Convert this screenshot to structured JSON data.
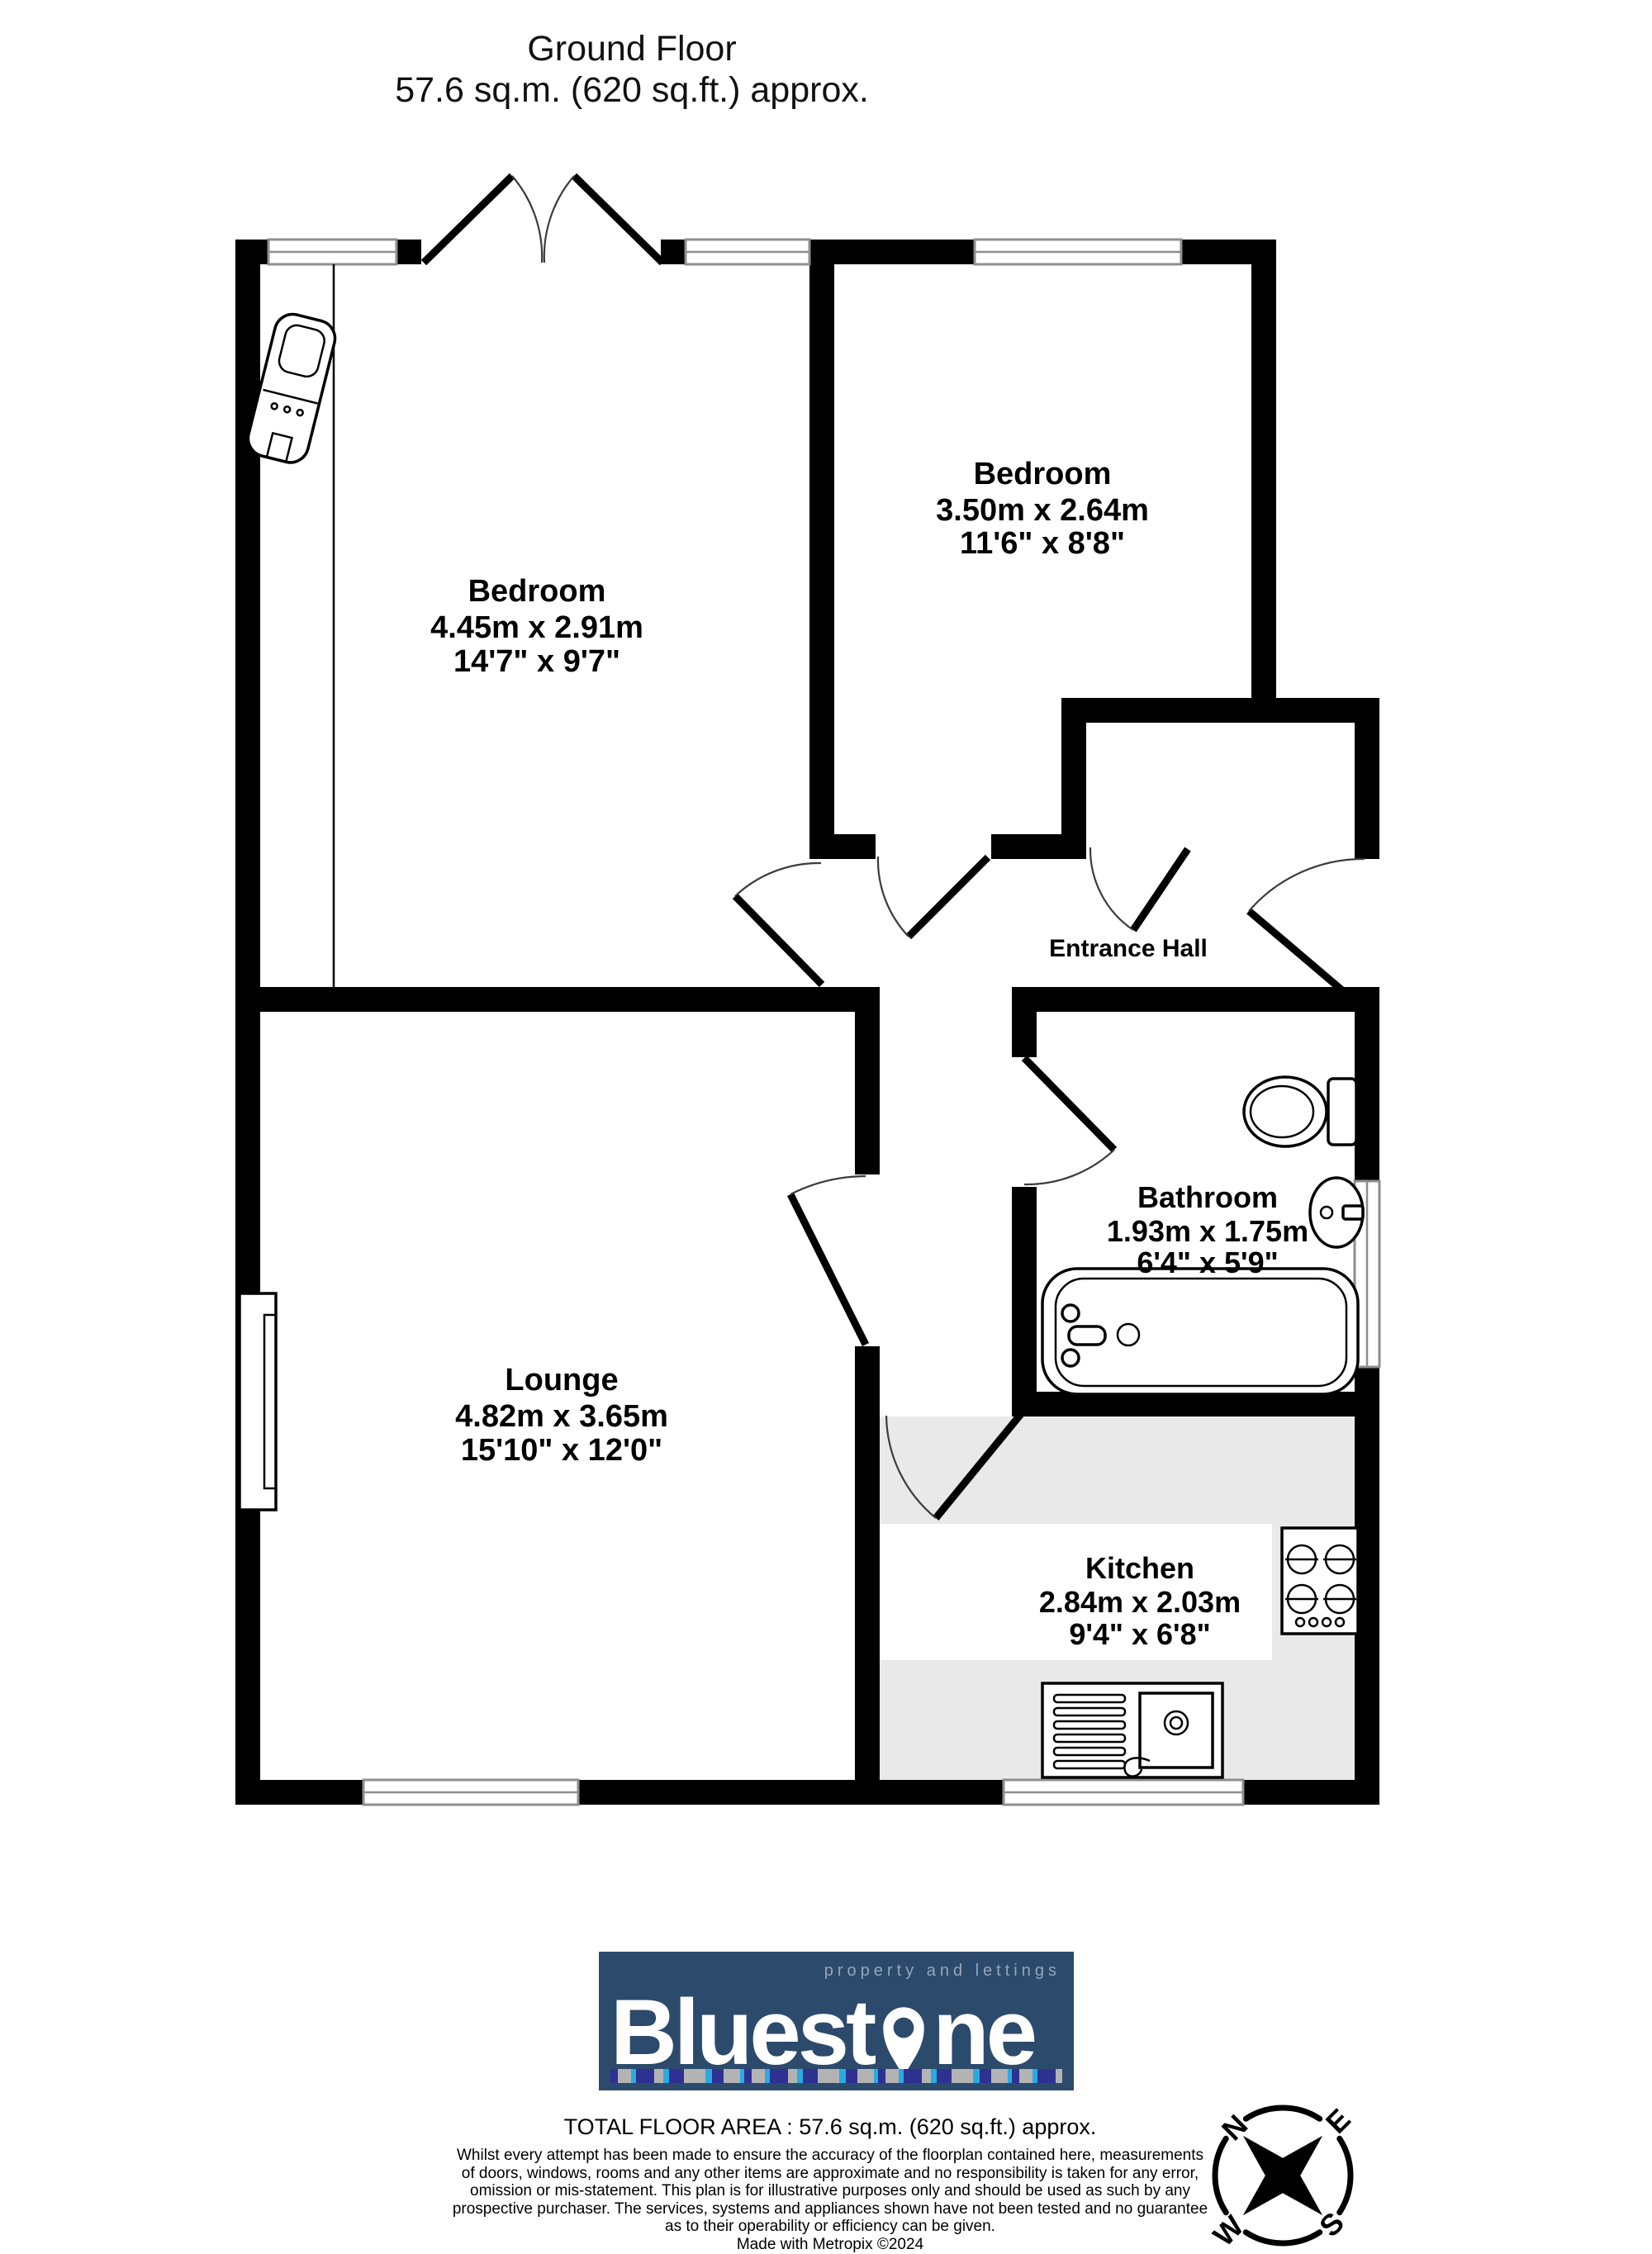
{
  "title": {
    "line1": "Ground Floor",
    "line2": "57.6 sq.m. (620 sq.ft.) approx."
  },
  "plan": {
    "bedroom1": {
      "name": "Bedroom",
      "metric": "4.45m  x 2.91m",
      "imperial": "14'7\"  x 9'7\""
    },
    "bedroom2": {
      "name": "Bedroom",
      "metric": "3.50m  x 2.64m",
      "imperial": "11'6\"  x 8'8\""
    },
    "entrance_hall": {
      "name": "Entrance Hall"
    },
    "bathroom": {
      "name": "Bathroom",
      "metric": "1.93m  x 1.75m",
      "imperial": "6'4\"  x 5'9\""
    },
    "lounge": {
      "name": "Lounge",
      "metric": "4.82m  x 3.65m",
      "imperial": "15'10\"  x 12'0\""
    },
    "kitchen": {
      "name": "Kitchen",
      "metric": "2.84m  x 2.03m",
      "imperial": "9'4\"  x 6'8\""
    }
  },
  "logo": {
    "brand_pre": "Bluest",
    "brand_post": "ne",
    "tagline": "property and lettings",
    "bg_color": "#2c4a6b",
    "tagline_color": "#93a5bb",
    "stripe_colors": [
      "#2e3192",
      "#ec008c",
      "#29abe2",
      "#ffffff",
      "#1b1464",
      "#b3b3b3",
      "#00a2e8",
      "#262262"
    ]
  },
  "footer": {
    "total_area": "TOTAL FLOOR AREA : 57.6 sq.m. (620 sq.ft.) approx.",
    "disclaimer_lines": [
      "Whilst every attempt has been made to ensure the accuracy of the floorplan contained here, measurements",
      "of doors, windows, rooms and any other items are approximate and no responsibility is taken for any error,",
      "omission or mis-statement. This plan is for illustrative purposes only and should be used as such by any",
      "prospective purchaser. The services, systems and appliances shown have not been tested and no guarantee",
      "as to their operability or efficiency can be given."
    ],
    "credit": "Made with Metropix ©2024"
  },
  "compass": {
    "north": "N",
    "east": "E",
    "south": "S",
    "west": "W"
  }
}
